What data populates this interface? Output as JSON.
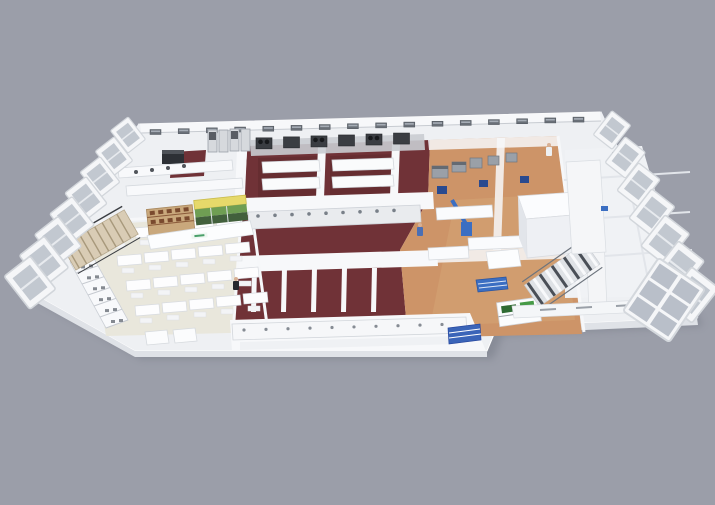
{
  "palette": {
    "bg": "#9b9ea9",
    "shadow": "#6b707c",
    "slab": "#eef0f3",
    "wall_white": "#f7f8fa",
    "wall_shade": "#dfe2e7",
    "floor_maroon": "#703237",
    "floor_maroon_dark": "#5f2a2e",
    "floor_wood": "#cd9468",
    "floor_wood_light": "#d8a877",
    "floor_beige": "#e9e7dc",
    "floor_gray": "#f0f2f5",
    "counter_white": "#fafbfc",
    "counter_top": "#e3e5e9",
    "equip_dark": "#3a3d42",
    "equip_gray": "#9aa0a8",
    "steel": "#c9ccd1",
    "glass": "#b9bfc9",
    "accent_blue": "#3b6ec2",
    "accent_navy": "#2a4a8f",
    "accent_yellow": "#e6d96a",
    "accent_green": "#6f9e53",
    "accent_green_dark": "#42603c",
    "shelf_tan": "#c9a87c",
    "shelf_brown": "#8a5a3a",
    "stair_tan": "#d9ccb5",
    "rail_dark": "#3a3d42",
    "window_dark": "#6a7078",
    "logo_green": "#4aa06a",
    "plant_green": "#2f6b33",
    "plant_green_light": "#469a46",
    "skin": "#d8b094"
  },
  "building": {
    "back_windows": 16,
    "left_panels": 8,
    "right_panels": 7,
    "cafeteria_tables": {
      "rows": 4,
      "cols": 5
    },
    "cook_units": 6,
    "steel_dots": 9,
    "bottom_dots": 10,
    "partitions": 5,
    "left_stair_steps": 8,
    "right_stair_steps": 10,
    "serving_rungs": 7,
    "display_content_dots": 10
  },
  "people": [
    {
      "x": 236,
      "y": 281,
      "color": "#26292e"
    },
    {
      "x": 420,
      "y": 227,
      "color": "#4a6fb5"
    },
    {
      "x": 549,
      "y": 147,
      "color": "#eef0f2"
    }
  ]
}
